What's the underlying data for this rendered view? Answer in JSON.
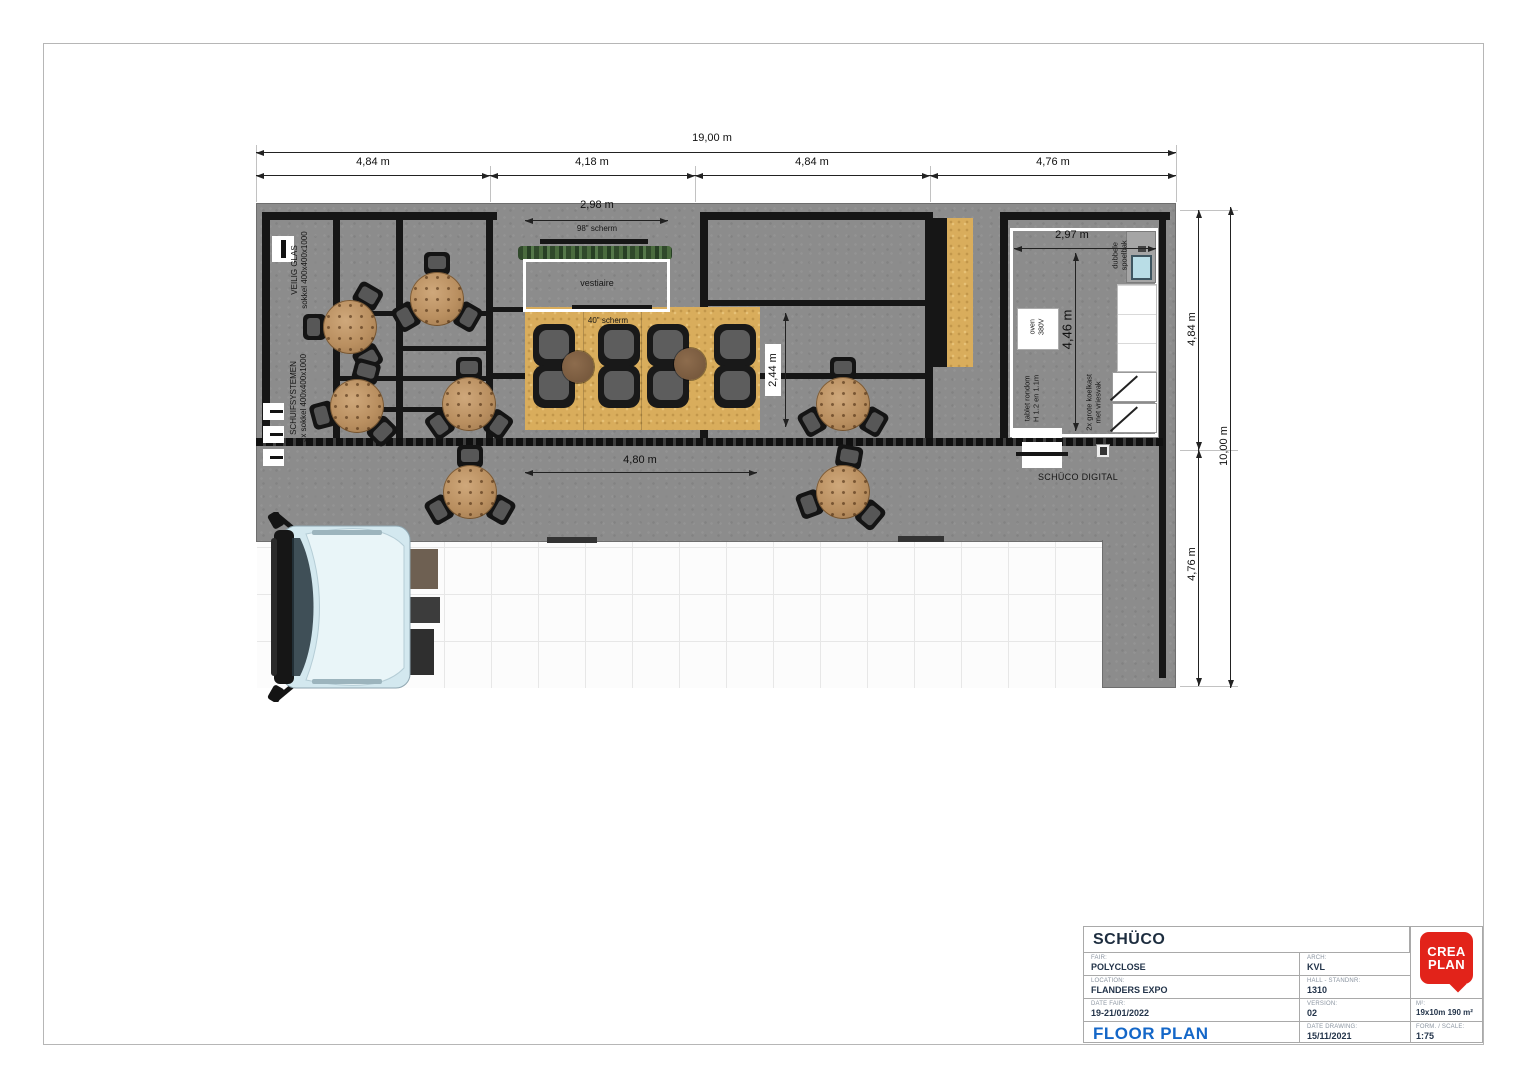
{
  "dimensions": {
    "top_total": "19,00 m",
    "top_segments": [
      "4,84 m",
      "4,18 m",
      "4,84 m",
      "4,76 m"
    ],
    "right_total": "10,00 m",
    "right_segment_top": "4,84 m",
    "right_segment_bottom": "4,76 m",
    "vestiaire_width": "2,98 m",
    "kitchen_width": "2,97 m",
    "kitchen_depth": "4,46 m",
    "lounge_depth": "2,44 m",
    "open_area_width": "4,80 m"
  },
  "labels": {
    "veilig_glas": "VEILIG GLAS\nsokkel 400x400x1000",
    "schuifsystemen": "SCHUIFSYSTEMEN\n3x sokkel 400x400x1000",
    "screen_98": "98\" scherm",
    "vestiaire": "vestiaire",
    "screen_40": "40\" scherm",
    "oven": "oven\n380V",
    "tablet": "tablet rondom\nH 1.2 en 1.1m",
    "koelkast": "2x grote koelkast\nmet vriesvak",
    "spoelbak": "dubbele\nspoelbak",
    "schuco_digital": "SCHÜCO DIGITAL"
  },
  "title_block": {
    "company": "SCHÜCO",
    "drawing_title": "FLOOR PLAN",
    "fair": {
      "label": "FAIR:",
      "value": "POLYCLOSE"
    },
    "location": {
      "label": "LOCATION:",
      "value": "FLANDERS EXPO"
    },
    "date_fair": {
      "label": "DATE FAIR:",
      "value": "19-21/01/2022"
    },
    "arch": {
      "label": "ARCH:",
      "value": "KVL"
    },
    "hall": {
      "label": "HALL - STANDNR:",
      "value": "1310"
    },
    "version": {
      "label": "VERSION:",
      "value": "02"
    },
    "date_drawing": {
      "label": "DATE DRAWING:",
      "value": "15/11/2021"
    },
    "area": {
      "label": "M²:",
      "value": "19x10m 190 m²"
    },
    "scale": {
      "label": "FORM. / SCALE:",
      "value": "1:75"
    },
    "logo": "CREA\nPLAN"
  },
  "colors": {
    "accent_blue": "#1565c0",
    "brand_red": "#e2231a",
    "wall_black": "#161616",
    "wood_gold": "#d9ad5c",
    "stand_gray": "#8c8c8c"
  }
}
